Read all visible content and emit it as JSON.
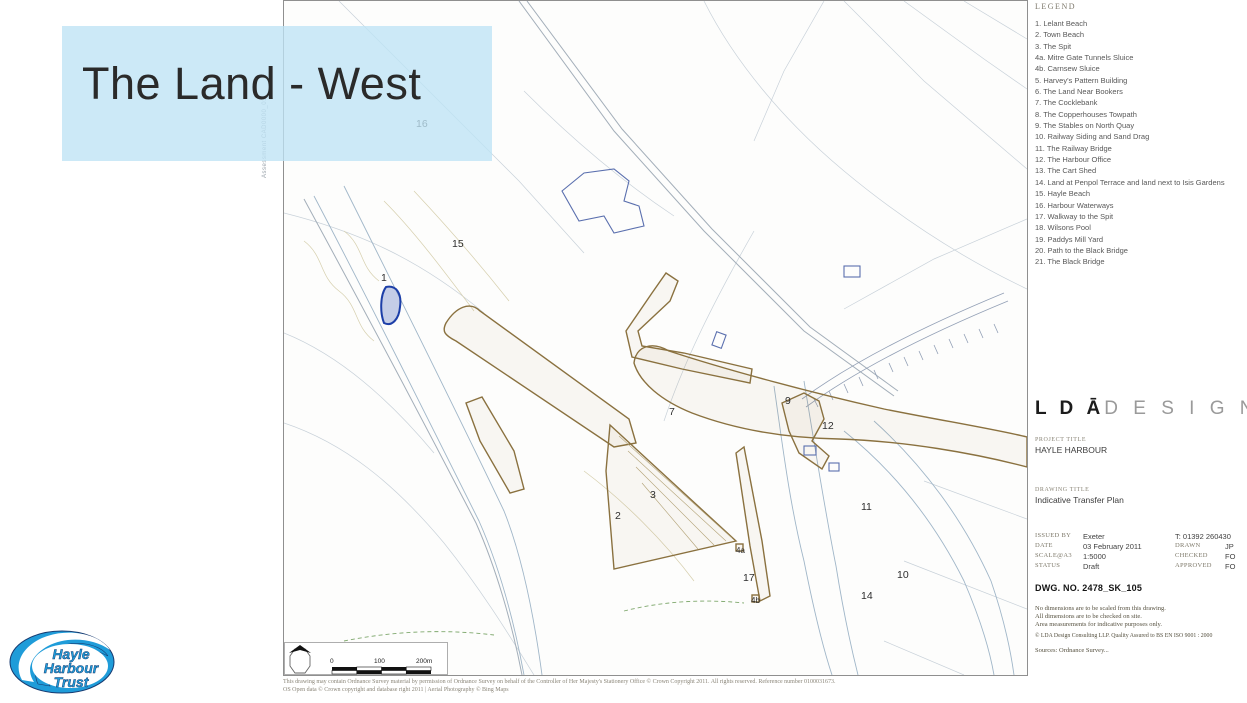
{
  "slide": {
    "title": "The Land - West"
  },
  "legend": {
    "header": "LEGEND",
    "items": [
      "1. Lelant Beach",
      "2. Town Beach",
      "3. The Spit",
      "4a. Mitre Gate Tunnels Sluice",
      "4b. Carnsew Sluice",
      "5. Harvey's Pattern Building",
      "6. The Land Near Bookers",
      "7. The Cocklebank",
      "8. The Copperhouses Towpath",
      "9. The Stables on North Quay",
      "10. Railway Siding and Sand Drag",
      "11. The Railway Bridge",
      "12. The Harbour Office",
      "13. The Cart Shed",
      "14. Land at Penpol Terrace and land next to Isis Gardens",
      "15. Hayle Beach",
      "16. Harbour Waterways",
      "17. Walkway to the Spit",
      "18. Wilsons Pool",
      "19. Paddys Mill Yard",
      "20. Path to the Black Bridge",
      "21. The Black Bridge"
    ]
  },
  "map": {
    "side_text": "Assessment CAD0000_01",
    "markers": [
      {
        "label": "1"
      },
      {
        "label": "2"
      },
      {
        "label": "3"
      },
      {
        "label": "4a"
      },
      {
        "label": "4b"
      },
      {
        "label": "7"
      },
      {
        "label": "9"
      },
      {
        "label": "10"
      },
      {
        "label": "11"
      },
      {
        "label": "12"
      },
      {
        "label": "14"
      },
      {
        "label": "15"
      },
      {
        "label": "16"
      },
      {
        "label": "17"
      }
    ],
    "scalebar": {
      "t0": "0",
      "t1": "100",
      "t2": "200m"
    },
    "footnote_line1": "This drawing may contain Ordnance Survey material by permission of Ordnance Survey on behalf of the Controller of Her Majesty's Stationery Office © Crown Copyright 2011. All rights reserved. Reference number 0100031673.",
    "footnote_line2": "OS Open data © Crown copyright and database right 2011     |     Aerial Photography © Bing Maps"
  },
  "titleblock": {
    "brand_bold": "L D Ā",
    "brand_light": "D E S I G N",
    "project_label": "PROJECT TITLE",
    "project": "HAYLE HARBOUR",
    "drawing_label": "DRAWING TITLE",
    "drawing": "Indicative Transfer Plan",
    "issue_rows": [
      {
        "label": "ISSUED BY",
        "value": "Exeter",
        "label2": "T: 01392 260430",
        "value2": ""
      },
      {
        "label": "DATE",
        "value": "03 February 2011",
        "label2": "DRAWN",
        "value2": "JP"
      },
      {
        "label": "SCALE@A3",
        "value": "1:5000",
        "label2": "CHECKED",
        "value2": "FO"
      },
      {
        "label": "STATUS",
        "value": "Draft",
        "label2": "APPROVED",
        "value2": "FO"
      }
    ],
    "dwg": "DWG. NO. 2478_SK_105",
    "notes": [
      "No dimensions are to be scaled from this drawing.",
      "All dimensions are to be checked on site.",
      "Area measurements for indicative purposes only."
    ],
    "copyright": "© LDA Design Consulting LLP.  Quality Assured to BS EN ISO 9001 : 2000",
    "sources": "Sources: Ordnance Survey..."
  },
  "logo": {
    "line1": "Hayle",
    "line2": "Harbour",
    "line3": "Trust"
  },
  "colors": {
    "overlay_blue": "#bee3f5",
    "parcel_brown": "#8a713f",
    "water_edge": "#a0b6c8",
    "highlight_blue": "#1d3fa8",
    "logo_blue": "#1f9cd9"
  }
}
